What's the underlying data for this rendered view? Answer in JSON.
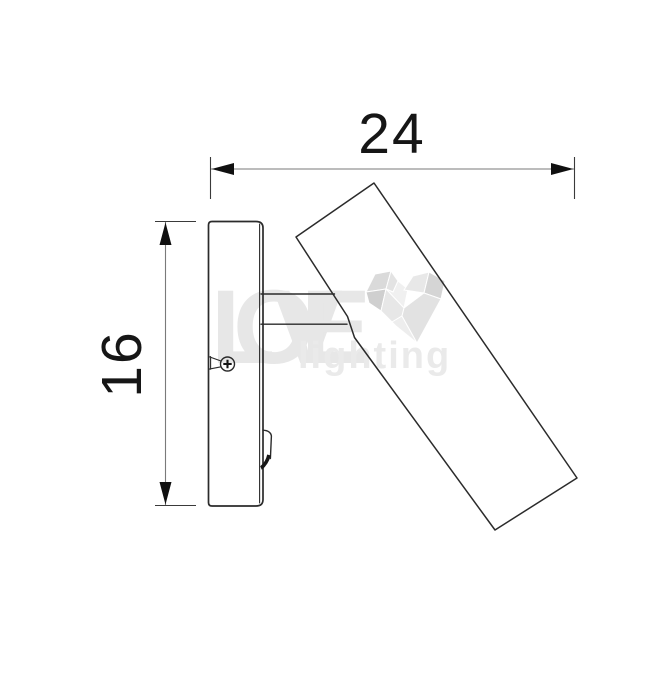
{
  "drawing": {
    "width_label": "24",
    "height_label": "16"
  },
  "watermark": {
    "brand": "LOVE",
    "subbrand": "lighting"
  },
  "colors": {
    "background": "#ffffff",
    "object_line": "#2b2b2b",
    "dimension_line": "#7a7a7a",
    "dimension_text": "#161616",
    "watermark_text": "#e7e7e7",
    "watermark_heart_dark": "#d2d2d2",
    "watermark_heart_light": "#ededed"
  }
}
